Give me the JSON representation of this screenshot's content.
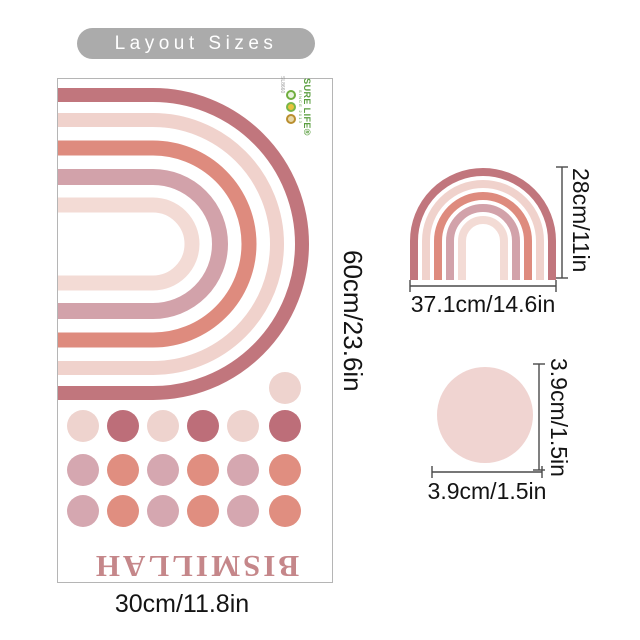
{
  "banner": {
    "label": "Layout Sizes"
  },
  "palette": {
    "banner_bg": "#ababab",
    "arc_colors": [
      "#c1767d",
      "#f0d2cc",
      "#de8b7e",
      "#d2a2aa",
      "#f3dbd5"
    ],
    "dot_colors": {
      "pale": "#eed3ce",
      "rose": "#bd6e79",
      "mauve": "#d5a7b0",
      "salmon": "#e08e80"
    },
    "circle_fill": "#f0d4d1",
    "word_color": "#c5878a",
    "dim_line_color": "#4a4a4a"
  },
  "sheet": {
    "word": "BISMILLAH",
    "width_label": "30cm/11.8in",
    "height_label": "60cm/23.6in",
    "brand": {
      "name": "SURE LIFE",
      "reg": "®",
      "since": "SINCE 2013",
      "code": "SL8660"
    },
    "dot_grid": [
      [
        null,
        null,
        null,
        null,
        null,
        "pale"
      ],
      [
        "pale",
        "rose",
        "pale",
        "rose",
        "pale",
        "rose"
      ],
      [
        "mauve",
        "salmon",
        "mauve",
        "salmon",
        "mauve",
        "salmon"
      ],
      [
        "mauve",
        "salmon",
        "mauve",
        "salmon",
        "mauve",
        "salmon"
      ]
    ]
  },
  "small_rainbow": {
    "width_label": "37.1cm/14.6in",
    "height_label": "28cm/11in"
  },
  "dot_item": {
    "width_label": "3.9cm/1.5in",
    "height_label": "3.9cm/1.5in"
  }
}
